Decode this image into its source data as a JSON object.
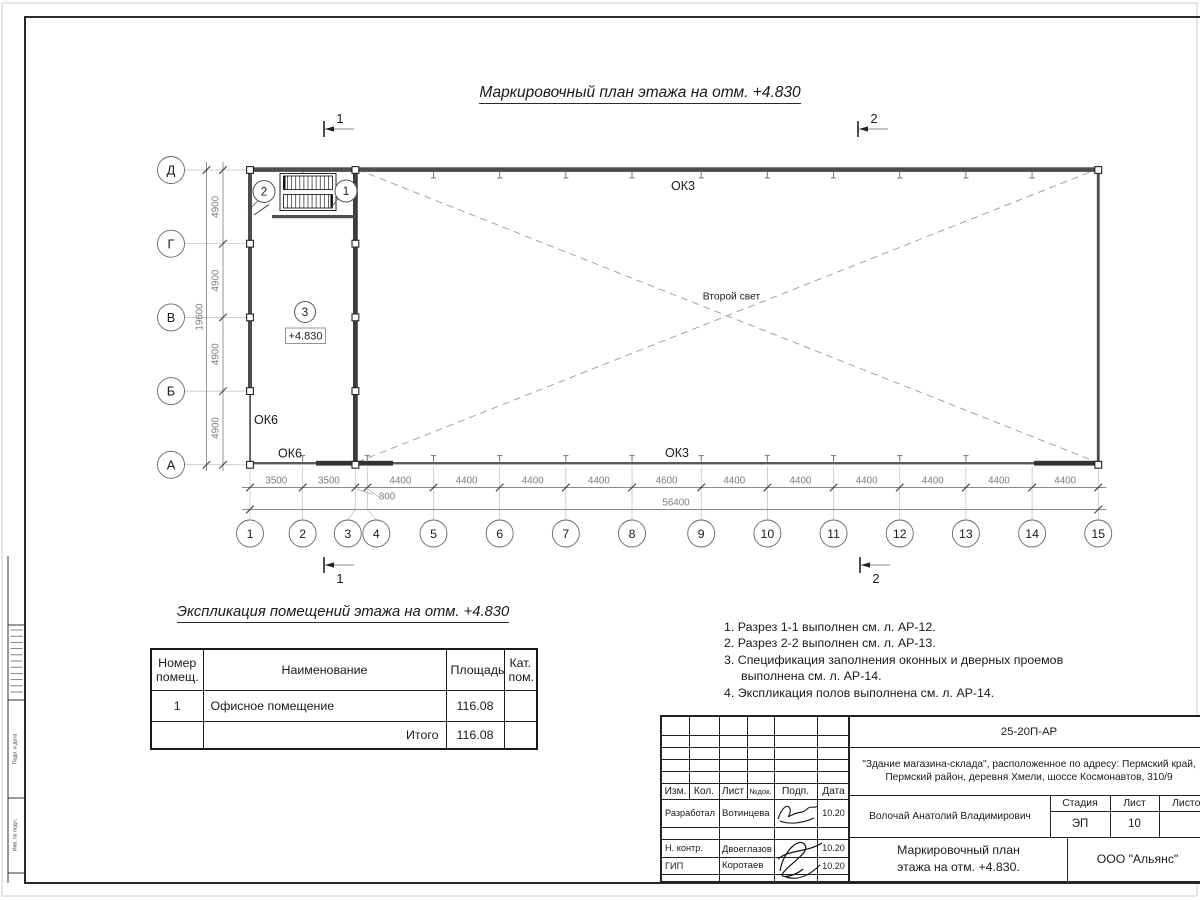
{
  "page": {
    "title": "Маркировочный план этажа на отм. +4.830"
  },
  "plan": {
    "bottom_axes": {
      "labels": [
        "1",
        "2",
        "3",
        "4",
        "5",
        "6",
        "7",
        "8",
        "9",
        "10",
        "11",
        "12",
        "13",
        "14",
        "15"
      ],
      "spans_mm": [
        3500,
        3500,
        800,
        4400,
        4400,
        4400,
        4400,
        4600,
        4400,
        4400,
        4400,
        4400,
        4400,
        4400
      ],
      "total_label": "56400",
      "sub_span_label": "800"
    },
    "left_axes": {
      "labels": [
        "Д",
        "Г",
        "В",
        "Б",
        "А"
      ],
      "spans_mm": [
        4900,
        4900,
        4900,
        4900
      ],
      "total_label": "19600"
    },
    "window_labels": {
      "ok3_top": "ОК3",
      "ok3_bottom": "ОК3",
      "ok6_left": "ОК6",
      "ok6_bottom": "ОК6"
    },
    "room": {
      "marker": "3",
      "elevation": "+4.830"
    },
    "stair_markers": {
      "left": "2",
      "right": "1"
    },
    "second_light": "Второй свет",
    "sections": {
      "s1": "1",
      "s2": "2"
    }
  },
  "explication": {
    "title": "Экспликация помещений этажа на отм. +4.830",
    "headers": [
      "Номер помещ.",
      "Наименование",
      "Площадь",
      "Кат. пом."
    ],
    "rows": [
      [
        "1",
        "Офисное помещение",
        "116.08",
        ""
      ]
    ],
    "total_label": "Итого",
    "total_value": "116.08"
  },
  "notes": [
    "1. Разрез 1-1 выполнен см. л. АР-12.",
    "2. Разрез 2-2 выполнен см. л. АР-13.",
    "3. Спецификация заполнения оконных и дверных проемов выполнена см. л. АР-14.",
    "4. Экспликация полов выполнена см. л. АР-14."
  ],
  "titleblock": {
    "doc_number": "25-20П-АР",
    "project_line1": "\"Здание магазина-склада\", расположенное по адресу: Пермский край,",
    "project_line2": "Пермский район, деревня Хмели, шоссе Космонавтов, 310/9",
    "header_cols": [
      "Изм.",
      "Кол.",
      "Лист",
      "№док.",
      "Подп.",
      "Дата"
    ],
    "rows": [
      {
        "role": "Разработал",
        "name": "Вотинцева",
        "date": "10.20"
      },
      {
        "role": "Н. контр.",
        "name": "Двоеглазов",
        "date": "10.20"
      },
      {
        "role": "ГИП",
        "name": "Коротаев",
        "date": "10.20"
      }
    ],
    "approver": "Волочай Анатолий Владимирович",
    "stage_label": "Стадия",
    "sheet_label": "Лист",
    "sheets_label": "Листов",
    "stage": "ЭП",
    "sheet": "10",
    "drawing_title_line1": "Маркировочный план",
    "drawing_title_line2": "этажа на отм. +4.830.",
    "company": "ООО \"Альянс\""
  },
  "left_strip": {
    "cells": [
      "Подп. и дата",
      "Инв. № подл."
    ]
  }
}
